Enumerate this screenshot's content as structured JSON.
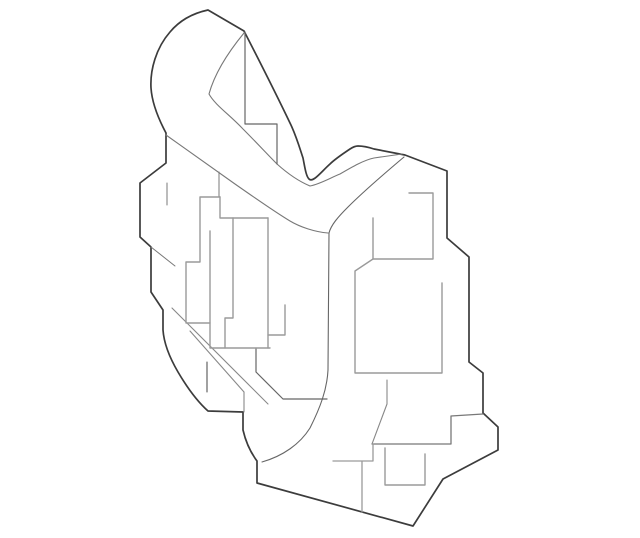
{
  "page": {
    "title": "part-line-diagram",
    "background_color": "#ffffff"
  },
  "drawing": {
    "canvas": {
      "width": 640,
      "height": 538
    },
    "colors": {
      "outline_dark": "#3c3c3c",
      "inner_medium": "#666666",
      "inner_thin": "#787878",
      "inner_light": "#9a9a9a"
    },
    "paths": [
      {
        "name": "outer-boundary",
        "stroke": "#3c3c3c",
        "width": 1.7,
        "d": "M 208,10 L 244,31 C 262,66 278,98 290,123 C 296,135 300,149 303,158 C 305,168 306,176 309,179 C 313,183 321,172 330,164 C 335,159 344,153 350,149 C 353,147 356,146 358,146 C 363,146 368,147 374,149 L 405,155 L 447,171 L 447,238 L 469,257 L 469,362 L 483,373 L 483,413 L 498,427 L 498,450 L 443,479 L 413,526 L 257,483 L 257,461 C 251,453 246,443 243,430 L 243,412 L 208,411 C 199,403 188,389 178,372 C 171,360 164,345 163,330 L 163,310 L 151,292 L 151,247 L 140,237 L 140,183 L 166,163 L 166,133 C 158,118 152,103 151,88 C 150,70 156,48 170,32 C 180,20 194,13 208,10 Z"
      },
      {
        "name": "band-inner-edge",
        "stroke": "#787878",
        "width": 1.1,
        "d": "M 244,33 C 230,50 215,72 209,94 C 215,105 230,115 243,129 C 256,142 268,155 277,164 C 287,173 298,181 310,186 C 320,184 330,178 340,174 C 352,167 364,160 374,158 L 402,154"
      },
      {
        "name": "upper-step-edge",
        "stroke": "#666666",
        "width": 1.2,
        "d": "M 245,32 L 245,124 L 277,124 L 277,164"
      },
      {
        "name": "mid-diagonal-edge",
        "stroke": "#787878",
        "width": 1.1,
        "d": "M 166,135 C 190,152 215,170 235,184 C 255,198 275,212 290,221 C 300,227 315,232 328,233"
      },
      {
        "name": "j-channel-edge",
        "stroke": "#666666",
        "width": 1.1,
        "d": "M 404,157 C 385,173 365,190 348,207 C 338,217 331,225 329,233 L 328,370 C 327,390 320,408 310,428 C 300,444 283,456 262,462"
      },
      {
        "name": "hidden-stub-left-top",
        "stroke": "#787878",
        "width": 1.0,
        "d": "M 167,183 L 167,205"
      },
      {
        "name": "hidden-stub-rect-top",
        "stroke": "#787878",
        "width": 1.0,
        "d": "M 219,172 L 219,197"
      },
      {
        "name": "hidden-diag-left",
        "stroke": "#787878",
        "width": 1.0,
        "d": "M 151,247 L 175,266"
      },
      {
        "name": "hidden-stub-center",
        "stroke": "#555555",
        "width": 1.1,
        "d": "M 207,362 L 207,392"
      },
      {
        "name": "j-left-stub",
        "stroke": "#888888",
        "width": 1.1,
        "d": "M 244,392 L 244,412"
      },
      {
        "name": "long-diagonal-a",
        "stroke": "#888888",
        "width": 1.1,
        "d": "M 172,308 L 268,404"
      },
      {
        "name": "long-diagonal-b",
        "stroke": "#888888",
        "width": 1.1,
        "d": "M 190,331 L 244,392"
      },
      {
        "name": "inner-hook-edge",
        "stroke": "#666666",
        "width": 1.2,
        "d": "M 256,348 L 256,372 L 283,399 L 327,399"
      },
      {
        "name": "left-recess-outline",
        "stroke": "#9a9a9a",
        "width": 1.4,
        "d": "M 220,197 L 200,197 L 200,262 L 186,262 L 186,323 L 210,323"
      },
      {
        "name": "left-recess-inner-vertical",
        "stroke": "#9a9a9a",
        "width": 1.4,
        "d": "M 210,231 L 210,348 L 270,348"
      },
      {
        "name": "left-recess-step",
        "stroke": "#9a9a9a",
        "width": 1.4,
        "d": "M 220,197 L 220,218 L 268,218"
      },
      {
        "name": "left-recess-mid-vertical",
        "stroke": "#9a9a9a",
        "width": 1.4,
        "d": "M 233,218 L 233,318 L 225,318 L 225,348"
      },
      {
        "name": "left-recess-right-vertical",
        "stroke": "#9a9a9a",
        "width": 1.4,
        "d": "M 268,218 L 268,348"
      },
      {
        "name": "center-step-edge",
        "stroke": "#9a9a9a",
        "width": 1.4,
        "d": "M 268,335 L 285,335 L 285,305"
      },
      {
        "name": "upper-right-recess",
        "stroke": "#9a9a9a",
        "width": 1.4,
        "d": "M 409,193 L 433,193 L 433,259 L 373,259 L 373,218"
      },
      {
        "name": "mid-right-recess",
        "stroke": "#9a9a9a",
        "width": 1.4,
        "d": "M 373,259 L 355,271 L 355,373 L 442,373 L 442,283"
      },
      {
        "name": "right-notch-edge",
        "stroke": "#787878",
        "width": 1.3,
        "d": "M 483,414 L 451,416 L 451,444 L 372,444"
      },
      {
        "name": "notch-diagonal-stub",
        "stroke": "#888888",
        "width": 1.1,
        "d": "M 387,380 L 387,404 L 372,444"
      },
      {
        "name": "bottom-left-step",
        "stroke": "#9a9a9a",
        "width": 1.3,
        "d": "M 373,444 L 373,461 M 333,461 L 373,461 M 362,461 L 362,512"
      },
      {
        "name": "bottom-small-recess",
        "stroke": "#9a9a9a",
        "width": 1.4,
        "d": "M 385,448 L 385,485 L 425,485 L 425,454"
      }
    ]
  }
}
